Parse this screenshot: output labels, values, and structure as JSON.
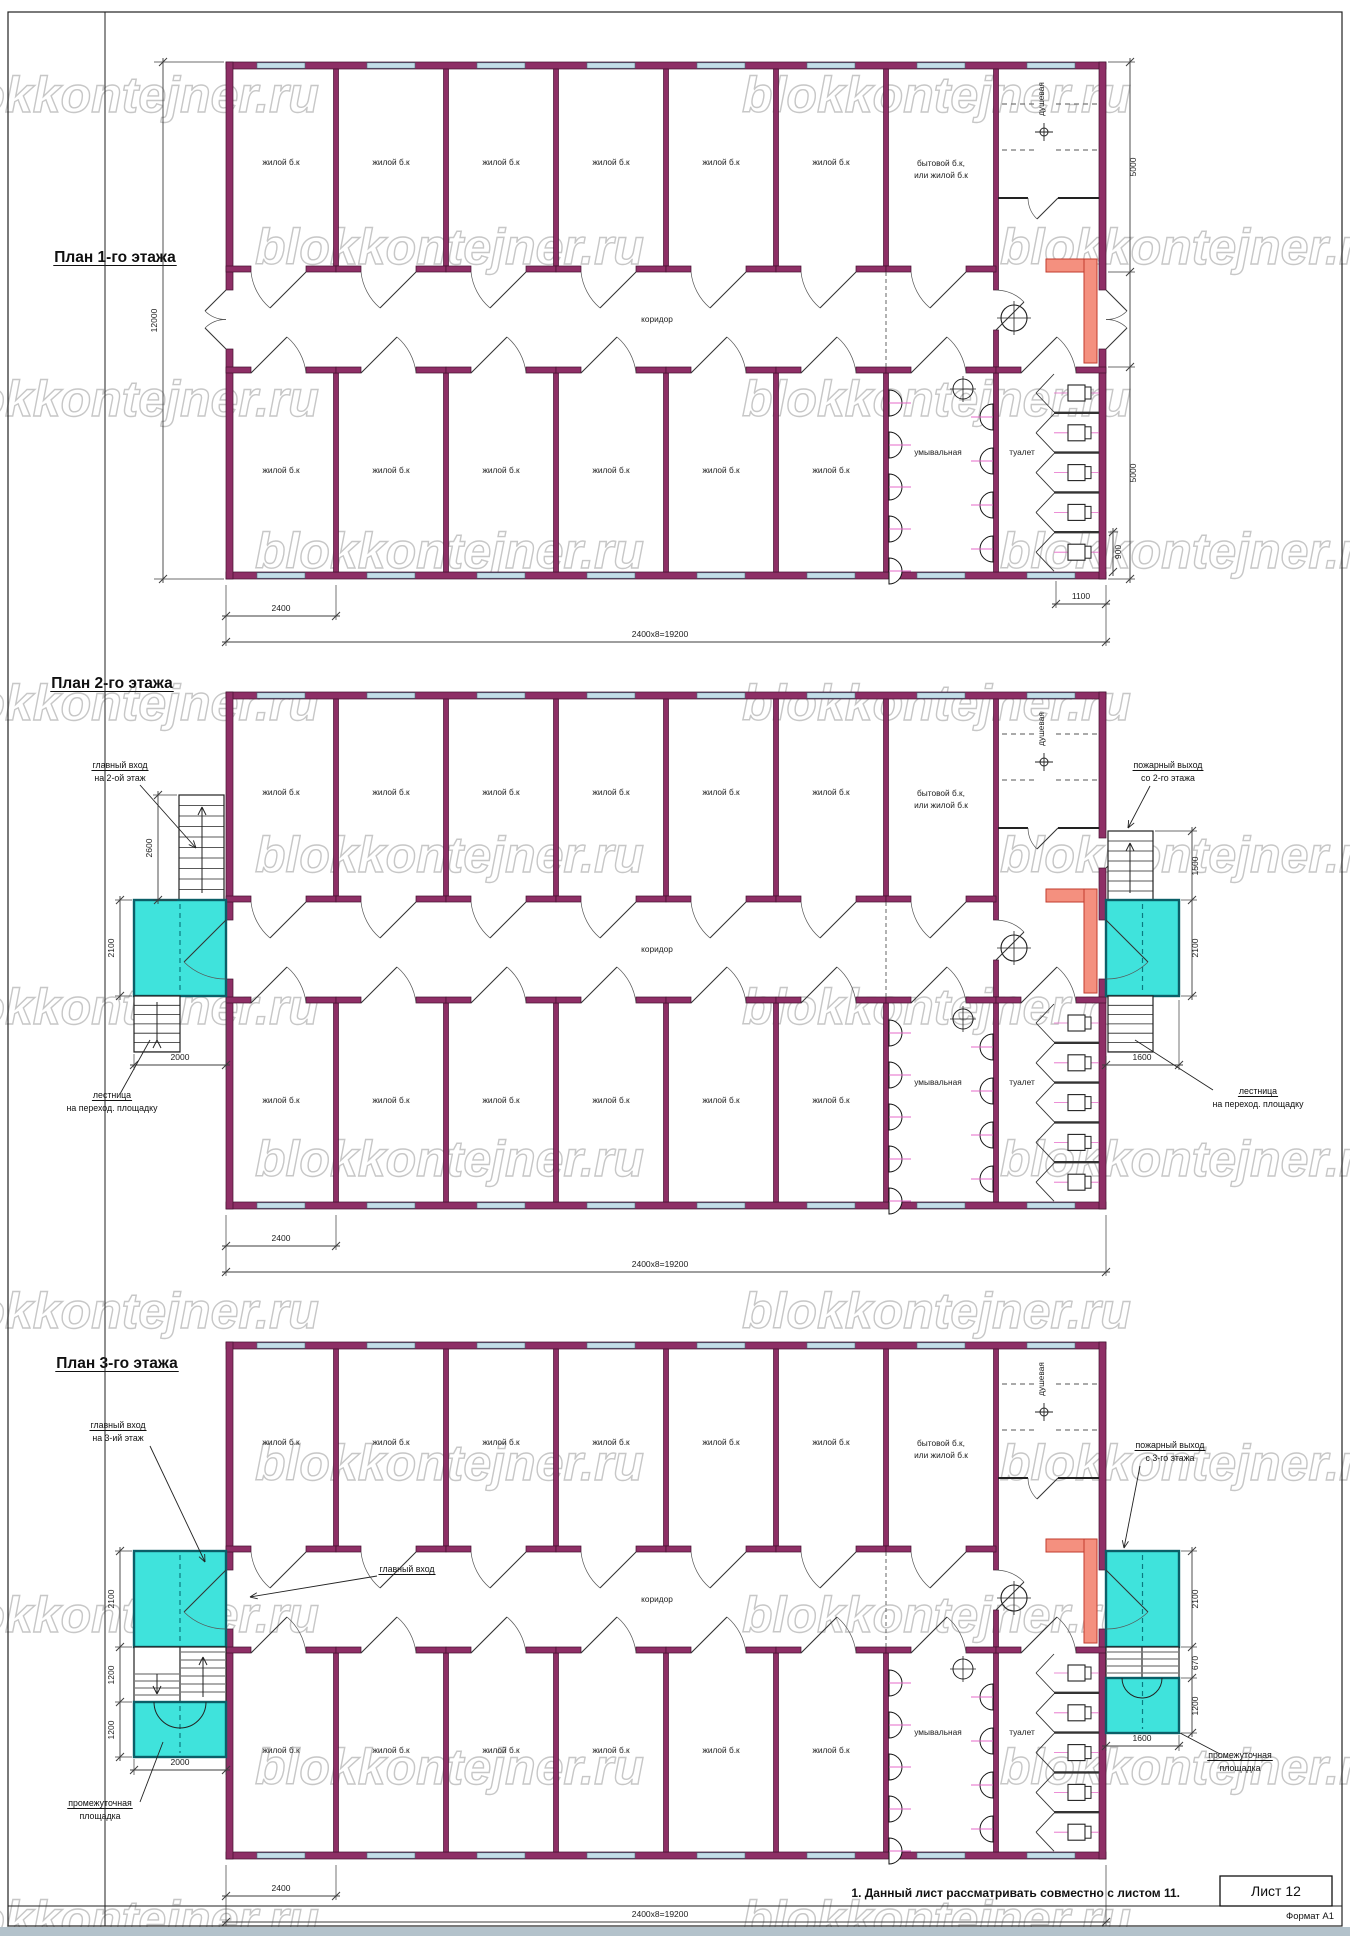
{
  "sheet": {
    "watermark": "blokkontejner.ru",
    "note": "1. Данный лист рассматривать совместно с листом 11.",
    "sheet_label": "Лист 12",
    "format_label": "Формат А1"
  },
  "labels": {
    "residential_room": "жилой б.к",
    "utility_room_line1": "бытовой б.к,",
    "utility_room_line2": "или жилой б.к",
    "corridor": "коридор",
    "shower": "душевая",
    "washroom": "умывальная",
    "toilet": "туалет"
  },
  "colors": {
    "wall": "#8e2f66",
    "wall_edge": "#43102f",
    "window": "#c3dde8",
    "window_edge": "#46707e",
    "landing": "#3fe3dc",
    "landing_edge": "#0b5f68",
    "heater": "#f4907f",
    "heater_edge": "#c23b2e",
    "fixture_line": "#e568c8",
    "dim_line": "#3c3c3c",
    "door_line": "#333333"
  },
  "floors": [
    {
      "title": "План 1-го этажа",
      "dims": {
        "module": "2400",
        "total": "2400x8=19200",
        "height": "12000",
        "top_row": "5000",
        "bottom_row": "5000",
        "stall": "900",
        "stall_depth": "1100"
      }
    },
    {
      "title": "План 2-го этажа",
      "dims": {
        "module": "2400",
        "total": "2400x8=19200",
        "flight": "2600",
        "landing": "2100",
        "landing_w": "2000",
        "r_flight": "1500",
        "r_landing": "2100",
        "r_landing_w": "1600"
      },
      "ann": {
        "entry": [
          "главный вход",
          "на 2-ой этаж"
        ],
        "stairs_l": [
          "лестница",
          "на переход. площадку"
        ],
        "exit": [
          "пожарный выход",
          "со 2-го этажа"
        ],
        "stairs_r": [
          "лестница",
          "на переход. площадку"
        ]
      }
    },
    {
      "title": "План 3-го этажа",
      "dims": {
        "module": "2400",
        "total": "2400x8=19200",
        "landing": "2100",
        "flight": "1200",
        "landing2": "1200",
        "landing_w": "2000",
        "r_landing": "2100",
        "r_flight": "670",
        "r_landing2": "1200",
        "r_landing_w": "1600"
      },
      "ann": {
        "entry": [
          "главный вход",
          "на 3-ий этаж"
        ],
        "main": "главный вход",
        "platform_l": [
          "промежуточная",
          "площадка"
        ],
        "exit": [
          "пожарный выход",
          "с 3-го этажа"
        ],
        "platform_r": [
          "промежуточная",
          "площадка"
        ]
      }
    }
  ]
}
